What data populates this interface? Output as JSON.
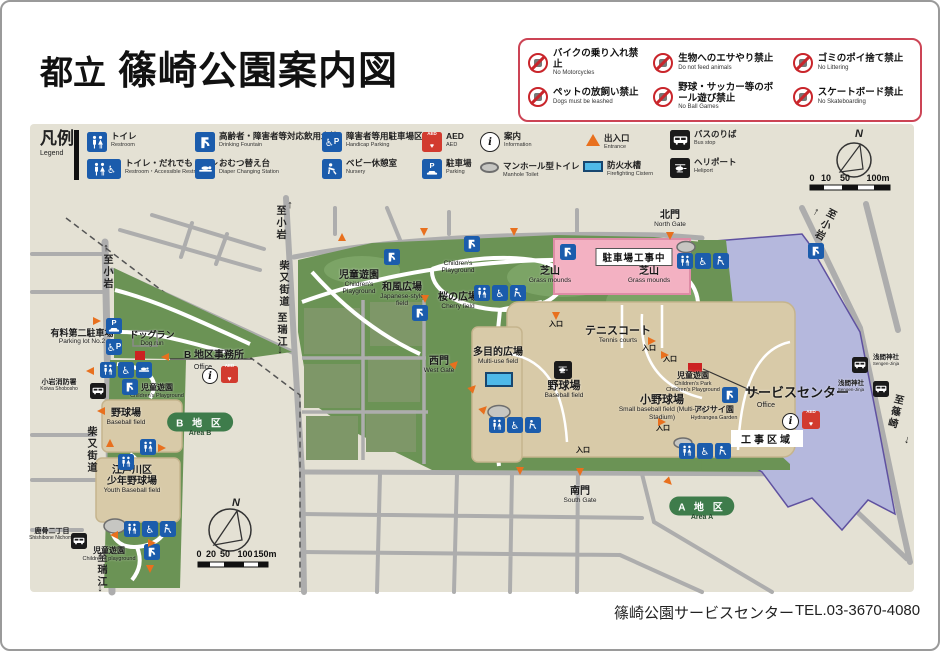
{
  "title": {
    "prefix": "都立",
    "main": "篠崎公園案内図"
  },
  "prohibitions": [
    {
      "ja": "バイクの乗り入れ禁止",
      "en": "No Motorcycles"
    },
    {
      "ja": "生物へのエサやり禁止",
      "en": "Do not feed animals"
    },
    {
      "ja": "ゴミのポイ捨て禁止",
      "en": "No Littering"
    },
    {
      "ja": "ペットの放飼い禁止",
      "en": "Dogs must be leashed"
    },
    {
      "ja": "野球・サッカー等のボール遊び禁止",
      "en": "No Ball Games"
    },
    {
      "ja": "スケートボード禁止",
      "en": "No Skateboarding"
    }
  ],
  "legend": {
    "title_ja": "凡例",
    "title_en": "Legend",
    "items": [
      {
        "ja": "トイレ",
        "en": "Restroom"
      },
      {
        "ja": "トイレ・だれでもトイレ",
        "en": "Restroom・Accessible Restroom"
      },
      {
        "ja": "高齢者・障害者等対応飲用水栓",
        "en": "Drinking Fountain"
      },
      {
        "ja": "おむつ替え台",
        "en": "Diaper Changing Station"
      },
      {
        "ja": "障害者等用駐車場区画",
        "en": "Handicap Parking"
      },
      {
        "ja": "ベビー休憩室",
        "en": "Nursery"
      },
      {
        "ja": "AED",
        "en": "AED"
      },
      {
        "ja": "駐車場",
        "en": "Parking"
      },
      {
        "ja": "案内",
        "en": "Information"
      },
      {
        "ja": "マンホール型トイレ",
        "en": "Manhole Toilet"
      },
      {
        "ja": "出入口",
        "en": "Entrance"
      },
      {
        "ja": "防火水槽",
        "en": "Firefighting Cistern"
      },
      {
        "ja": "バスのりば",
        "en": "Bus stop"
      },
      {
        "ja": "ヘリポート",
        "en": "Heliport"
      }
    ]
  },
  "compass": {
    "label": "N"
  },
  "scale_top": {
    "t0": "0",
    "t1": "10",
    "t2": "50",
    "t3": "100m"
  },
  "scale_bottom": {
    "t0": "0",
    "t1": "20",
    "t2": "50",
    "t3": "100",
    "t4": "150m"
  },
  "icons": {
    "aed_text": "AED",
    "info_text": "i",
    "p_text": "P"
  },
  "map": {
    "entrance": "入口",
    "symbols": {
      "arrow_up": "↑",
      "arrow_down": "↓"
    },
    "roads": {
      "to_koiwa": "至小岩",
      "shibamata": "柴又街道",
      "to_mizue": "至瑞江",
      "to_shinozaki": "至篠崎"
    },
    "a": {
      "north_gate_ja": "北門",
      "north_gate_en": "North Gate",
      "construction_zone": "工事区域",
      "parking_construction": "駐車場工事中",
      "grass_ja": "芝山",
      "grass_en": "Grass mounds",
      "cpw_ja": "児童遊園",
      "cpw_en": "Children's Playground",
      "jf_ja": "和風広場",
      "jf_en": "Japanese-style field",
      "cherry_ja": "桜の広場",
      "cherry_en": "Cherry field",
      "tennis_ja": "テニスコート",
      "tennis_en": "Tennis courts",
      "west_gate_ja": "西門",
      "west_gate_en": "West Gate",
      "multi_ja": "多目的広場",
      "multi_en": "Multi-use field",
      "bb_ja": "野球場",
      "bb_en": "Baseball field",
      "sbb_ja": "小野球場",
      "sbb_en": "Small baseball field (Multi-use Stadium)",
      "cpe_ja": "児童遊園",
      "cpe_en1": "Children's Park",
      "cpe_en2": "Children's Playground",
      "hyd_ja": "アジサイ園",
      "hyd_en": "Hydrangea Garden",
      "sc_ja": "サービスセンター",
      "sc_en": "Office",
      "sengen_ja": "浅間神社",
      "sengen_en": "Sengen-Jinja",
      "south_gate_ja": "南門",
      "south_gate_en": "South Gate",
      "pill_ja": "A 地 区",
      "pill_en": "Area A"
    },
    "b": {
      "p2_ja": "有料第二駐車場",
      "p2_en": "Parking lot No.2",
      "dog_ja": "ドッグラン",
      "dog_en": "Dog run",
      "office_ja": "B 地区事務所",
      "office_en": "Office",
      "fire_ja": "小岩消防署",
      "fire_en": "Koiwa Shobosho",
      "cpn_ja": "児童遊園",
      "cpn_en": "Children's Playground",
      "bb_ja": "野球場",
      "bb_en": "Baseball field",
      "pill_ja": "B 地 区",
      "pill_en": "Area B",
      "youth_ja1": "江戸川区",
      "youth_ja2": "少年野球場",
      "youth_en": "Youth Baseball field",
      "shishi_ja": "鹿骨二丁目",
      "shishi_en": "Shishibone Nichome",
      "cps_ja": "児童遊園",
      "cps_en": "Children's playground"
    }
  },
  "footer": {
    "name": "篠崎公園サービスセンター",
    "tel": "TEL.03-3670-4080"
  },
  "colors": {
    "beige": "#E4E1D4",
    "park_green": "#6B9355",
    "field_tan": "#D8CAA8",
    "construction_lavender": "#B5B8DD",
    "construction_pink": "#F3B1C2",
    "icon_blue": "#1B5CAC",
    "entrance_orange": "#E8701E",
    "prohibition_red": "#C9252B",
    "area_pill_green": "#3E7C4B"
  }
}
